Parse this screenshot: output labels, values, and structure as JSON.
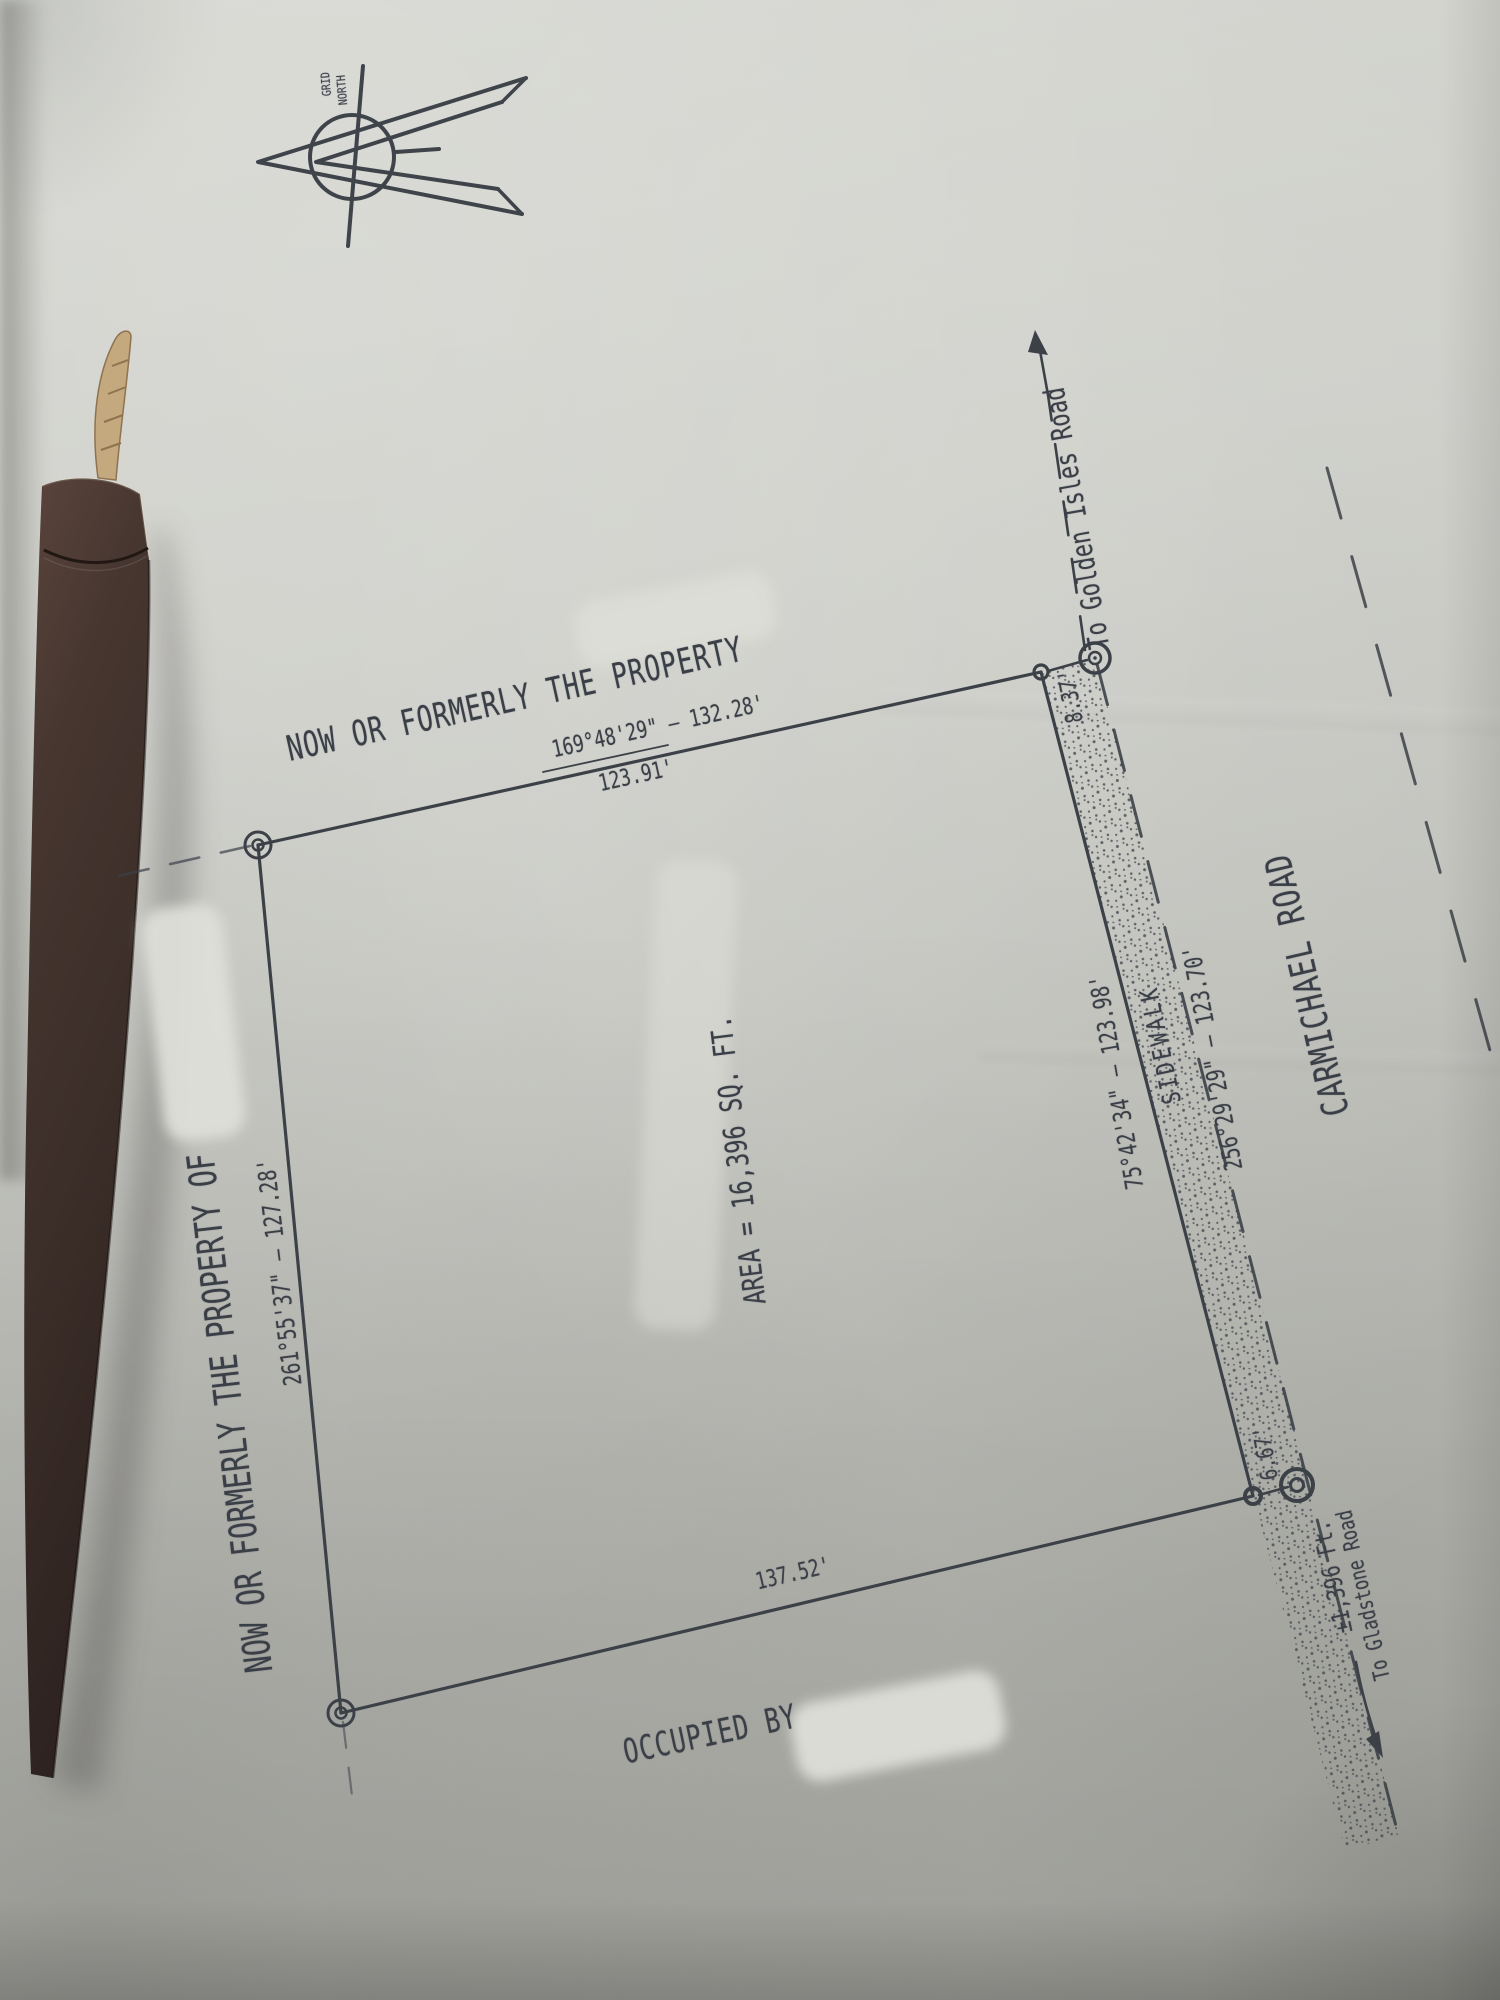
{
  "document_kind": "land survey plat (photograph of paper drawing)",
  "north_arrow": {
    "label_line1": "GRID",
    "label_line2": "NORTH"
  },
  "labels": {
    "north_adjoiner": "NOW OR FORMERLY THE PROPERTY",
    "west_adjoiner": "NOW OR FORMERLY THE PROPERTY OF",
    "south_adjoiner": "OCCUPIED BY",
    "area": "AREA = 16,396 SQ. FT.",
    "north_bearing": "169°48'29\" – 132.28'",
    "north_chord": "123.91'",
    "west_bearing": "261°55'37\" – 127.28'",
    "east_bearing": "75°42'34\" – 123.98'",
    "row_bearing": "256°29'29\" – 123.70'",
    "south_distance": "137.52'",
    "sidewalk": "SIDEWALK",
    "tie_north": "8.37'",
    "tie_south": "6.67'",
    "street_name": "CARMICHAEL ROAD",
    "to_golden_isles": "To Golden Isles Road",
    "gladstone_distance": "±1,396 Ft.",
    "to_gladstone": "To Gladstone Road"
  },
  "colors": {
    "ink": "#3a3f47",
    "paper": "#cbccc6",
    "strap_leather": "#46342e",
    "cord_tan": "#c4a87e"
  }
}
